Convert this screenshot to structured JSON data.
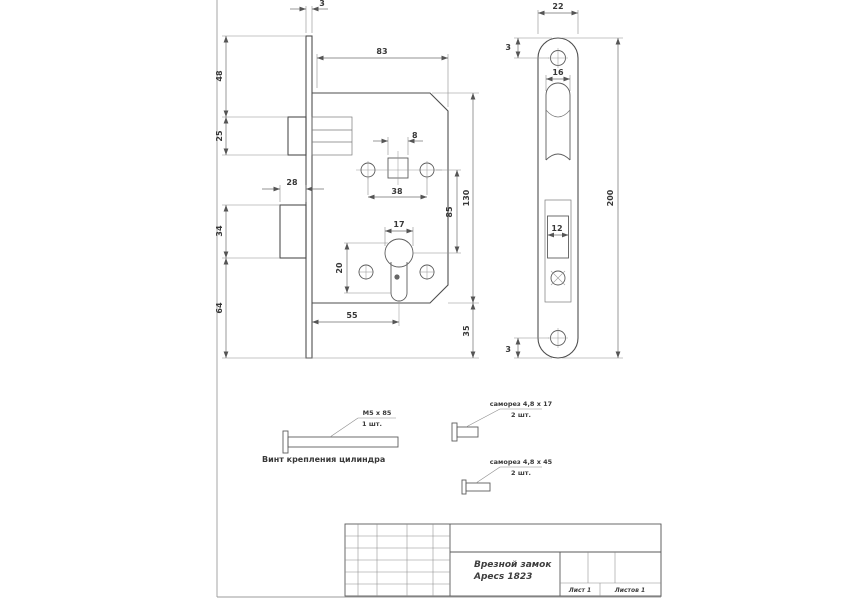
{
  "sheet": {
    "title_block": {
      "name_line1": "Врезной замок",
      "name_line2": "Apecs 1823",
      "sheet": "Лист 1",
      "sheets": "Листов 1"
    },
    "notes": {
      "cylinder_screw_caption": "Винт крепления цилиндра",
      "cylinder_screw_spec": "М5 х 85",
      "cylinder_screw_qty": "1 шт.",
      "faceplate_screw_spec": "саморез 4,8 х 17",
      "faceplate_screw_qty": "2 шт.",
      "mount_screw_spec": "саморез 4,8 х 45",
      "mount_screw_qty": "2 шт."
    },
    "dims": {
      "front": {
        "faceplate_thickness": "3",
        "body_width": "83",
        "top_to_latch": "48",
        "latch_height": "25",
        "deadbolt_throw": "28",
        "deadbolt_height": "34",
        "deadbolt_to_bottom": "64",
        "spindle_square": "8",
        "handle_screw_span": "38",
        "cylinder_width": "17",
        "cylinder_offset": "20",
        "backset": "55",
        "centers": "85",
        "body_height": "130",
        "body_to_plate_bottom": "35"
      },
      "plate": {
        "width": "22",
        "top_edge": "3",
        "latch_cutout": "16",
        "bolt_cutout": "12",
        "length": "200",
        "bottom_edge": "3"
      }
    }
  }
}
